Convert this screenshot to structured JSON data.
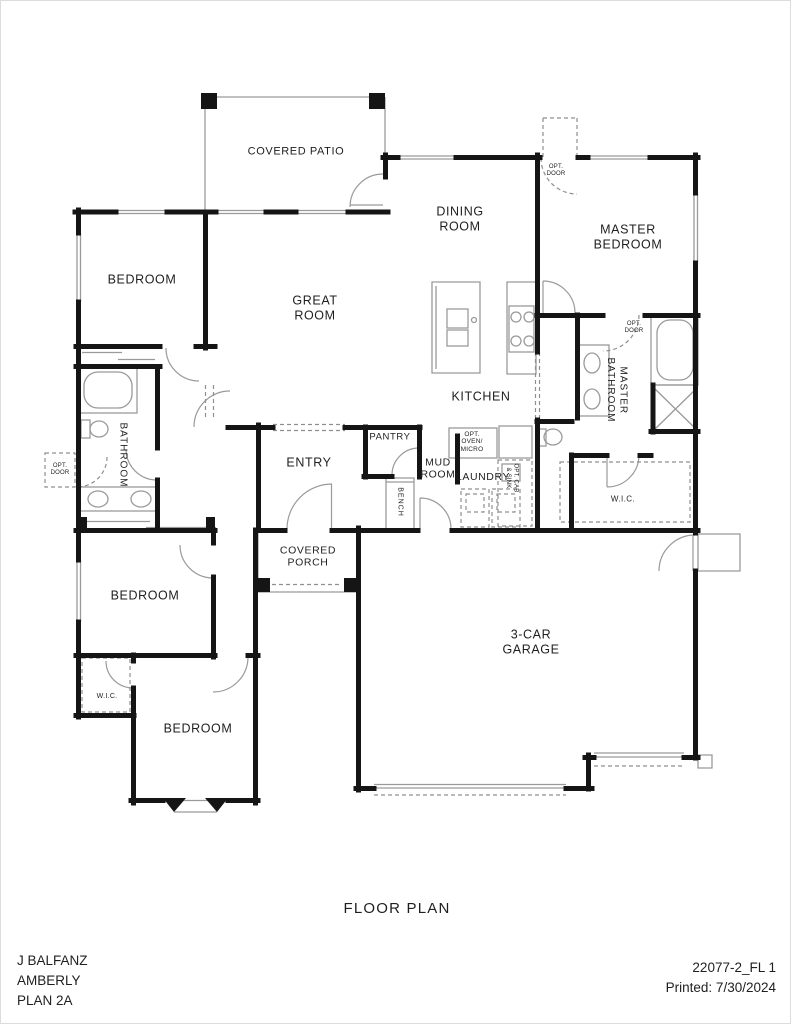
{
  "colors": {
    "background": "#ffffff",
    "walls": "#151515",
    "thin_lines": "#9a9a9a",
    "text": "#1f1f1f"
  },
  "rooms": {
    "covered_patio": "COVERED PATIO",
    "dining_room": "DINING\nROOM",
    "master_bedroom": "MASTER\nBEDROOM",
    "bedroom_top": "BEDROOM",
    "great_room": "GREAT\nROOM",
    "kitchen": "KITCHEN",
    "bathroom": "BATHROOM",
    "entry": "ENTRY",
    "pantry": "PANTRY",
    "mud_room": "MUD\nROOM",
    "laundry": "LAUNDRY",
    "master_bathroom": "MASTER\nBATHROOM",
    "wic_master": "W.I.C.",
    "covered_porch": "COVERED\nPORCH",
    "bedroom_middle": "BEDROOM",
    "wic_bedroom": "W.I.C.",
    "bedroom_bottom": "BEDROOM",
    "garage": "3-CAR\nGARAGE",
    "bench": "BENCH"
  },
  "annotations": {
    "opt_oven_micro": "OPT.\nOVEN/\nMICRO",
    "opt_cab_sink": "OPT. CAB\n& SINK",
    "opt_door_master_entry": "OPT.\nDOOR",
    "opt_door_bathroom": "OPT.\nDOOR",
    "opt_door_master_bath": "OPT.\nDOOR"
  },
  "title": {
    "drawing_title": "FLOOR PLAN"
  },
  "title_block": {
    "client": "J BALFANZ",
    "community": "AMBERLY",
    "plan": "PLAN 2A",
    "sheet": "22077-2_FL 1",
    "printed": "Printed: 7/30/2024"
  }
}
